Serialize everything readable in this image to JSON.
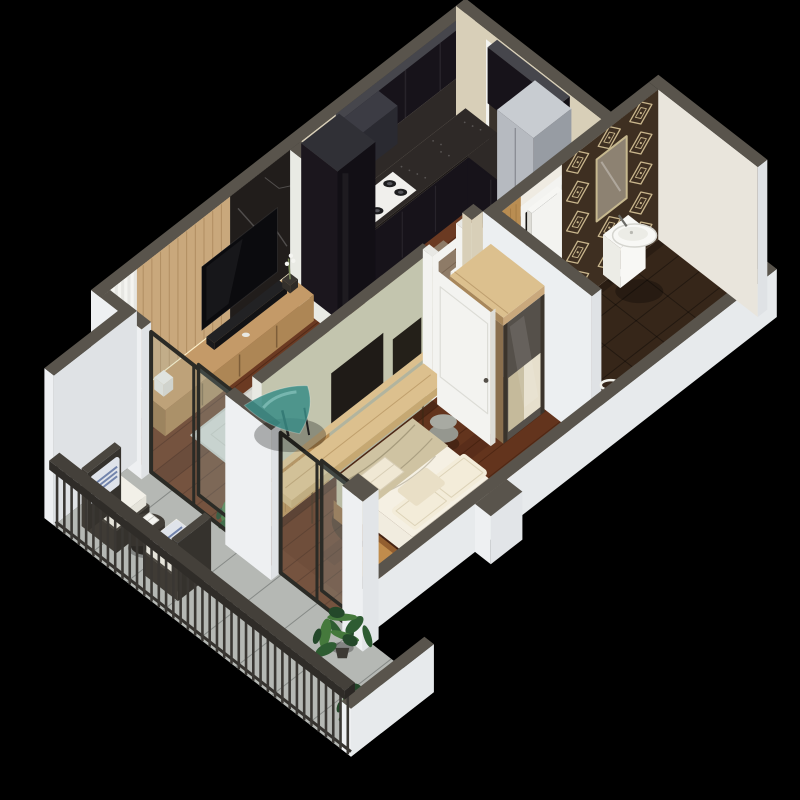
{
  "scene": {
    "type": "3d-isometric-apartment-floor-plan",
    "rooms": [
      {
        "name": "living-room",
        "furniture": [
          "tv-wall-wood-panel",
          "tv",
          "media-console",
          "soundbar",
          "glass-coffee-table",
          "area-rug",
          "curtain",
          "potted-plant"
        ]
      },
      {
        "name": "kitchen-dining",
        "furniture": [
          "l-shaped-black-counter",
          "gas-cooktop",
          "upper-cabinets",
          "tall-cabinet",
          "hood",
          "dining-table",
          "dining-chairs"
        ]
      },
      {
        "name": "hallway",
        "furniture": [
          "entry-door",
          "gray-wardrobe-cabinet"
        ]
      },
      {
        "name": "bedroom",
        "furniture": [
          "double-bed",
          "pillows",
          "throw-blanket",
          "wall-desk",
          "pouf",
          "mirrored-wardrobe",
          "nightstand",
          "white-door"
        ]
      },
      {
        "name": "bathroom",
        "furniture": [
          "wall-hung-sink",
          "mirror",
          "diamond-pattern-wall",
          "wood-accent-strip",
          "towel-rail"
        ]
      },
      {
        "name": "balcony",
        "furniture": [
          "rattan-chair",
          "rattan-chair",
          "round-side-table",
          "book",
          "railing",
          "potted-plants",
          "sliding-glass-doors"
        ]
      }
    ]
  },
  "colors": {
    "background": "#000000",
    "wallCap": "#59544c",
    "wallCapDark": "#4e4942",
    "wallOuterLight": "#eef0f2",
    "wallOuterShade": "#dfe2e5",
    "wallBeige": "#d8cfb8",
    "wallSage": "#c3c5ae",
    "wallSageShade": "#b2b49e",
    "wallWhite": "#f2f2ef",
    "bathTileWall": "#e9e5dc",
    "floorWood": "#6b3a22",
    "floorWoodLine": "rgba(45,16,6,0.38)",
    "floorWoodDark": "rgba(30,10,4,0.14)",
    "bedroomTint": "rgba(60,22,6,0.16)",
    "floorTile": "#b5b8b4",
    "tileLine": "rgba(88,92,90,0.5)",
    "rug": "#d9d9d3",
    "rugEdge": "#c7c7c0",
    "bathFloor": "#362619",
    "bathFloorLine": "rgba(0,0,0,0.35)",
    "patternBg": "#3e2f21",
    "patternFg": "#c9b68c",
    "woodPanel": "#c9a87c",
    "woodGrain": "rgba(122,82,40,0.3)",
    "woodLight": "#dcc08e",
    "woodMid": "#b98d52",
    "woodDark": "#8a6f4e",
    "marble": "#211d1b",
    "marbleVein": "rgba(255,255,255,0.22)",
    "led": "#fff3cf",
    "cabinetBlack": "#17131a",
    "cabinetBlackDark": "#120f15",
    "cabinetBlackSide": "#1b161d",
    "cabinetTopBand": "#46464c",
    "granite": "#2e2927",
    "graniteEdge": "#1c1817",
    "speckle": "rgba(220,220,220,0.25)",
    "stove": "#f0efec",
    "burner": "#1d1d1f",
    "burnerRing": "#54545a",
    "consoleWood": "#ad8655",
    "consoleTop": "#c49a68",
    "consoleSide": "#9a7648",
    "tv": "#0b0b0e",
    "tvGlint": "rgba(255,255,255,0.05)",
    "soundbar": "#121214",
    "tableTop": "#8e7b67",
    "tableSide": "#6e5d4d",
    "tableLeft": "#7d6a58",
    "legDark": "#3a302a",
    "chairWhite": "#f0f0eb",
    "chairShade": "#e2e2dd",
    "chairTop": "#f5f5f1",
    "grayCab": "#b6bac0",
    "grayCabSide": "#979ca3",
    "grayCabTop": "#c8ccd1",
    "entryDoor": "#3a332c",
    "doorWhite": "#f3f3f0",
    "doorWhiteEdge": "#dddcd6",
    "mirror": "#8d8272",
    "mirrorFrame": "#c6b88f",
    "wardrobeMirror": "#55504a",
    "mirrorBedBeige": "#d2c5a4",
    "mirrorBedCream": "#e9e3d2",
    "bedBase": "#8a5a2e",
    "bedBaseSide": "#935f30",
    "mattress": "#f5f0e3",
    "mattressSide": "#e9e3d3",
    "mattressLeft": "#f1ecdf",
    "throw": "#cfc3a2",
    "throwSide": "#c3b694",
    "foldLine": "rgba(120,108,80,0.35)",
    "pillow": "#f3ecd9",
    "pillowEdge": "#ddd3b8",
    "pillowAccent": "#e9dfc6",
    "sink": "#f8f8f5",
    "sinkShade": "#ecece6",
    "sinkLine": "#d5d5cf",
    "pouf": "#95978f",
    "poufTop": "#a8aaa2",
    "rattan": "#3f3b35",
    "rattanDark": "#35322d",
    "rattanTop": "#4a463f",
    "cushion": "#f2f0e8",
    "cushionSide": "#e5e3da",
    "pillowBlue": "#dfe3ea",
    "pillowStripe": "#5f74a2",
    "railing": "#3a3733",
    "railTop": "#44403a",
    "railSide": "#2f2c28",
    "glass": "rgba(168,198,202,0.18)",
    "glassFrame": "#2b2b26",
    "teal": "rgba(58,140,134,0.85)",
    "tealHi": "rgba(160,215,210,0.5)",
    "plantDark": "#24482a",
    "plant": "#2e5c32",
    "plantLight": "#45793c",
    "pot": "#3c3934",
    "shadow": "rgba(0,0,0,0.28)",
    "ao": "rgba(0,0,0,0.22)",
    "white": "#f4f4f0"
  }
}
